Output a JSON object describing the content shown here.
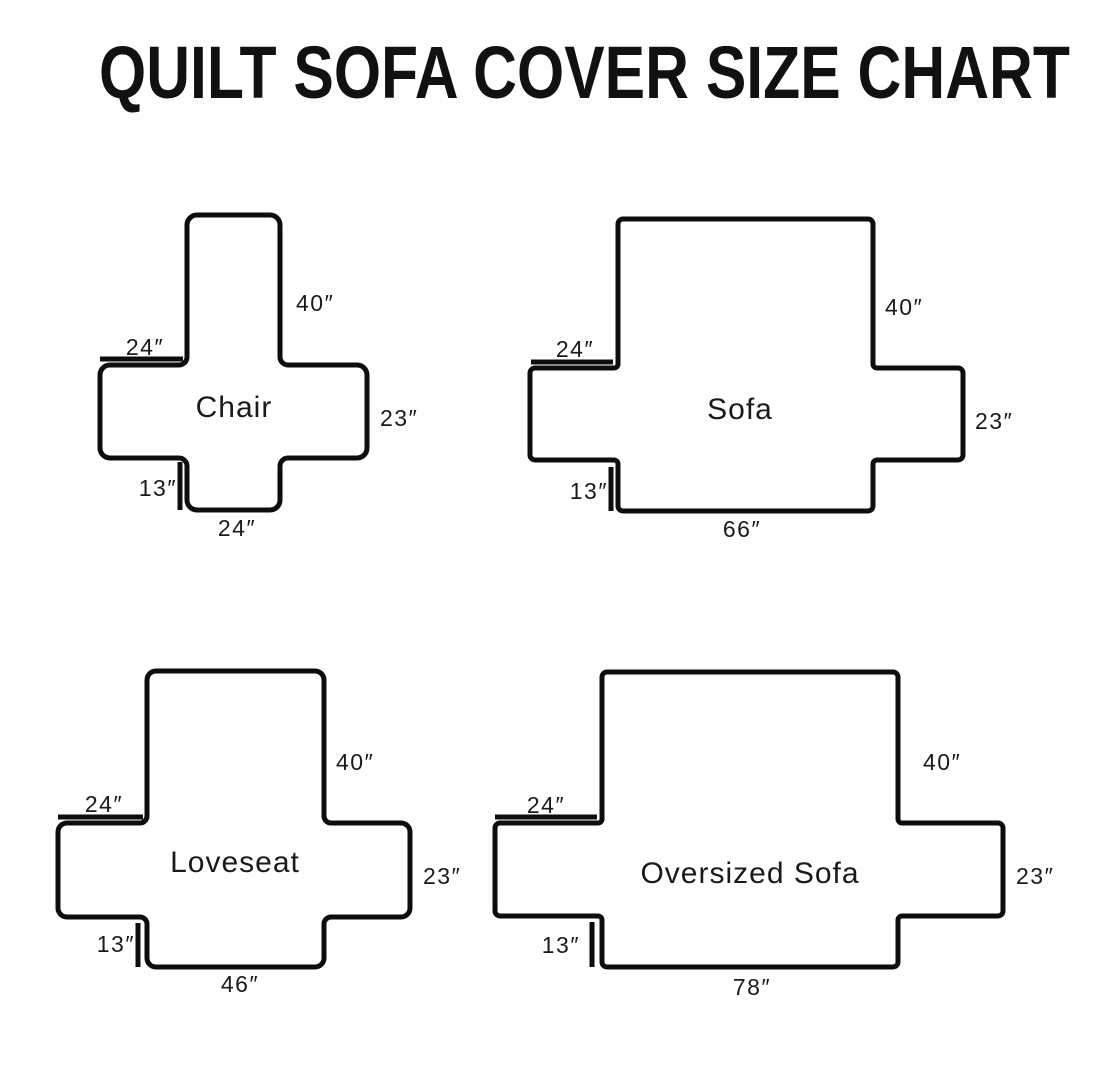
{
  "title": "QUILT SOFA COVER SIZE CHART",
  "diagrams": {
    "chair": {
      "name": "Chair",
      "back_height": "40″",
      "arm_top_width": "24″",
      "arm_side_height": "23″",
      "front_skirt_height": "13″",
      "seat_front_width": "24″"
    },
    "sofa": {
      "name": "Sofa",
      "back_height": "40″",
      "arm_top_width": "24″",
      "arm_side_height": "23″",
      "front_skirt_height": "13″",
      "seat_front_width": "66″"
    },
    "loveseat": {
      "name": "Loveseat",
      "back_height": "40″",
      "arm_top_width": "24″",
      "arm_side_height": "23″",
      "front_skirt_height": "13″",
      "seat_front_width": "46″"
    },
    "oversized_sofa": {
      "name": "Oversized Sofa",
      "back_height": "40″",
      "arm_top_width": "24″",
      "arm_side_height": "23″",
      "front_skirt_height": "13″",
      "seat_front_width": "78″"
    }
  }
}
